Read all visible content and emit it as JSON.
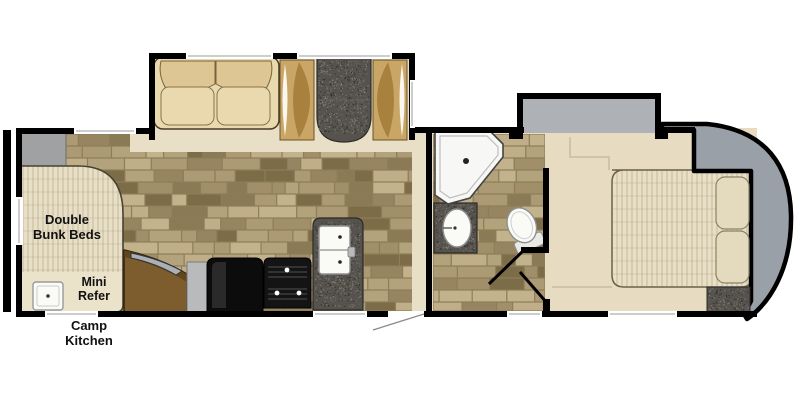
{
  "floorplan": {
    "labels": {
      "bunk": "Double Bunk Beds",
      "mini_refer": "Mini Refer",
      "camp_kitchen": "Camp Kitchen"
    },
    "elements": {
      "sofa": "sofa",
      "dinette": "booth-dinette",
      "tv_cabinet": "curved-tv-cabinet",
      "refrigerator": "refrigerator",
      "range": "range-stove",
      "kitchen_sink": "double-kitchen-sink",
      "bath_sink": "bathroom-sink",
      "shower": "neo-angle-shower",
      "toilet": "toilet",
      "bed": "queen-bed",
      "nightstand": "nightstand",
      "wardrobe_slide": "bedroom-slide-out",
      "camp_sink": "camp-kitchen-sink"
    },
    "colors": {
      "interior_cream": "#e7dcc1",
      "walkway_cream": "#e9dfc7",
      "grout": "#8d7d58",
      "tile_palette": [
        "#b3a37d",
        "#a08f69",
        "#c3b38d",
        "#8a7a55",
        "#978562",
        "#bfae87",
        "#7c6c48",
        "#ab9a73"
      ],
      "speckle_base": "#56534e",
      "speckle_dots": [
        "#6b675f",
        "#3b3935",
        "#787265",
        "#2e2c29",
        "#8a8378"
      ],
      "wall": "#000000",
      "window_line": "#9b9b9b",
      "slide_gray": "#aeb1b6",
      "cap_gray": "#9aa0a8",
      "cabinet_gray": "#9fa1a3",
      "wood": "#7d5c2d",
      "wood_dark": "#5d4118",
      "sofa_cream": "#e9d9ae",
      "sofa_back": "#dec694",
      "bench_tan": "#c9a665",
      "bench_inner": "#a9813f",
      "mattress": "#e8dfc6",
      "mattress_line": "#a89c7c",
      "fixture_white": "#f7f7f5",
      "step_line": "#cfc3a8"
    }
  }
}
